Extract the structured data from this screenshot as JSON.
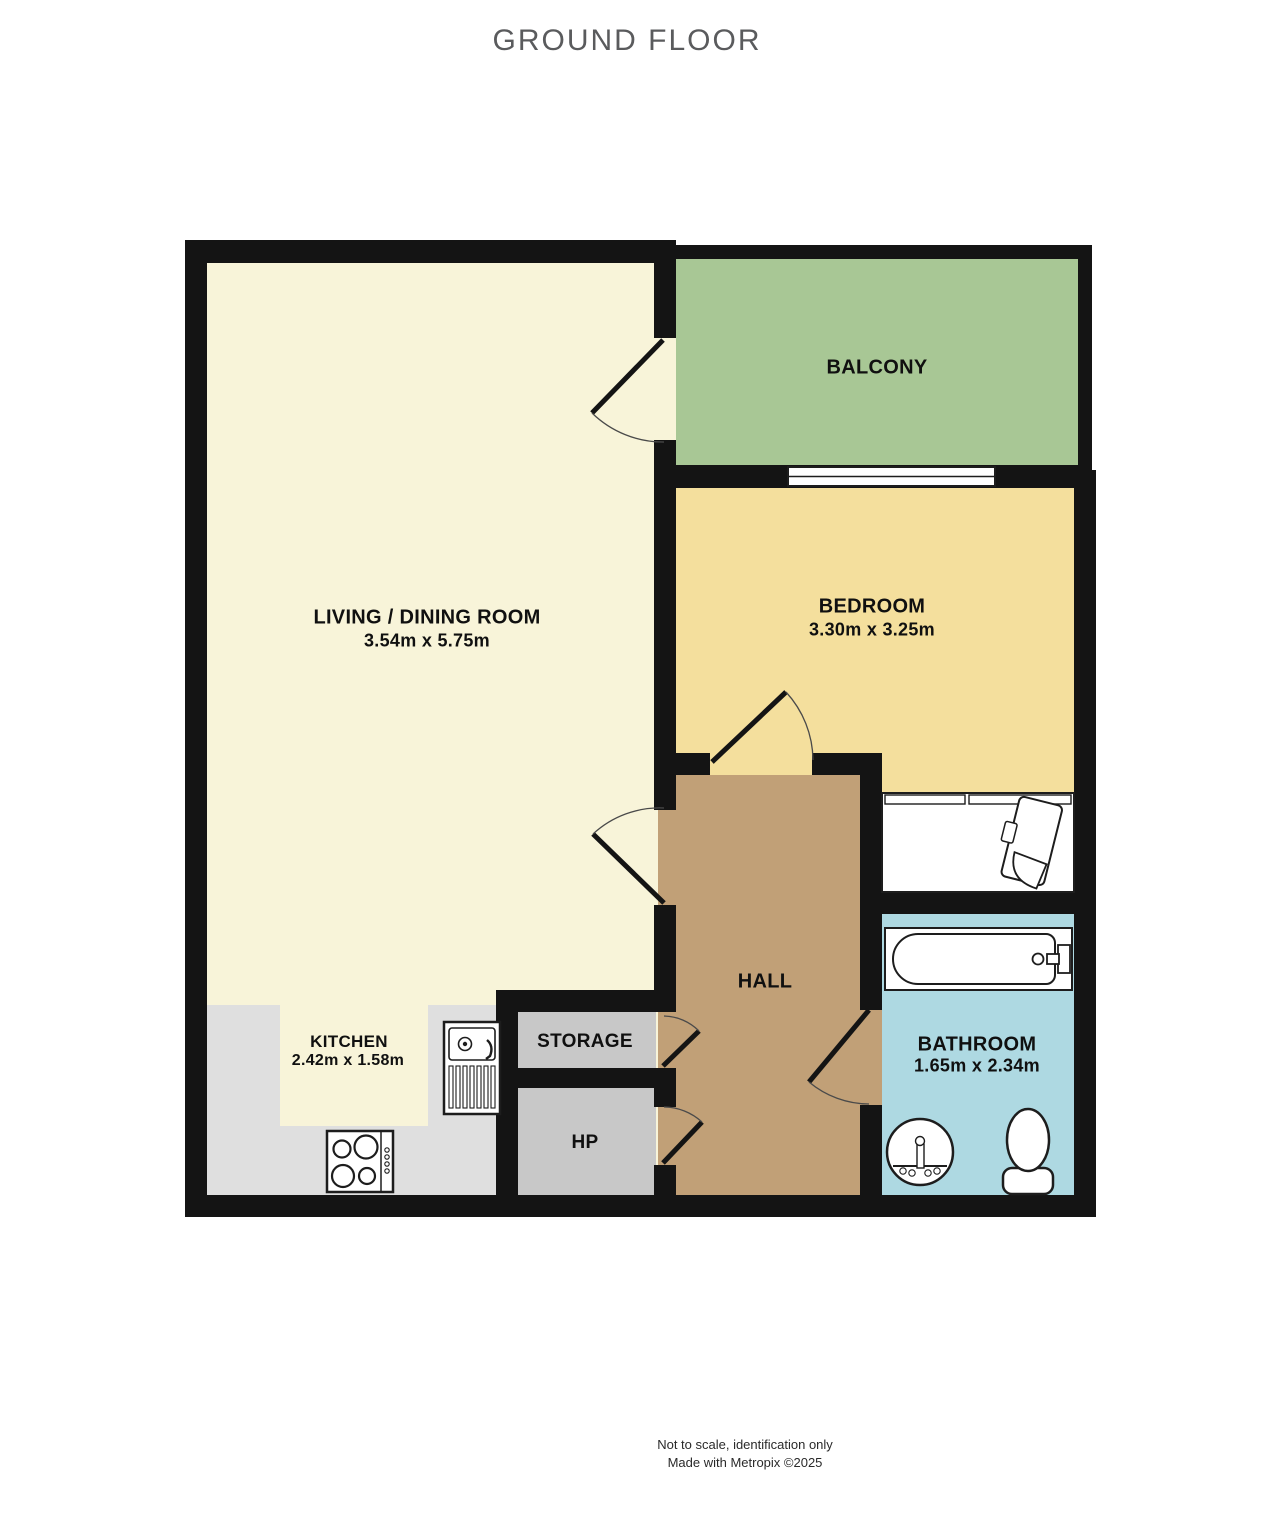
{
  "title": "GROUND FLOOR",
  "rooms": {
    "living": {
      "name": "LIVING / DINING ROOM",
      "dims": "3.54m  x 5.75m",
      "color": "#f8f4d9"
    },
    "balcony": {
      "name": "BALCONY",
      "color": "#a8c795"
    },
    "bedroom": {
      "name": "BEDROOM",
      "dims": "3.30m  x 3.25m",
      "color": "#f4df9d"
    },
    "hall": {
      "name": "HALL",
      "color": "#c1a077"
    },
    "kitchen": {
      "name": "KITCHEN",
      "dims": "2.42m  x 1.58m",
      "color": "#dfdfdf",
      "floor_inset_color": "#f8f4d9"
    },
    "storage": {
      "name": "STORAGE",
      "color": "#c8c8c8"
    },
    "hp": {
      "name": "HP",
      "color": "#c8c8c8"
    },
    "bathroom": {
      "name": "BATHROOM",
      "dims": "1.65m  x 2.34m",
      "color": "#aed9e2"
    }
  },
  "fixtures": [
    "window",
    "bathtub",
    "toilet",
    "wash-basin",
    "kitchen-sink",
    "hob",
    "wardrobe",
    "chair"
  ],
  "palette": {
    "wall": "#141414",
    "title_text": "#5a5b5d"
  },
  "footer": {
    "line1": "Not to scale, identification only",
    "line2": "Made with Metropix ©2025"
  }
}
